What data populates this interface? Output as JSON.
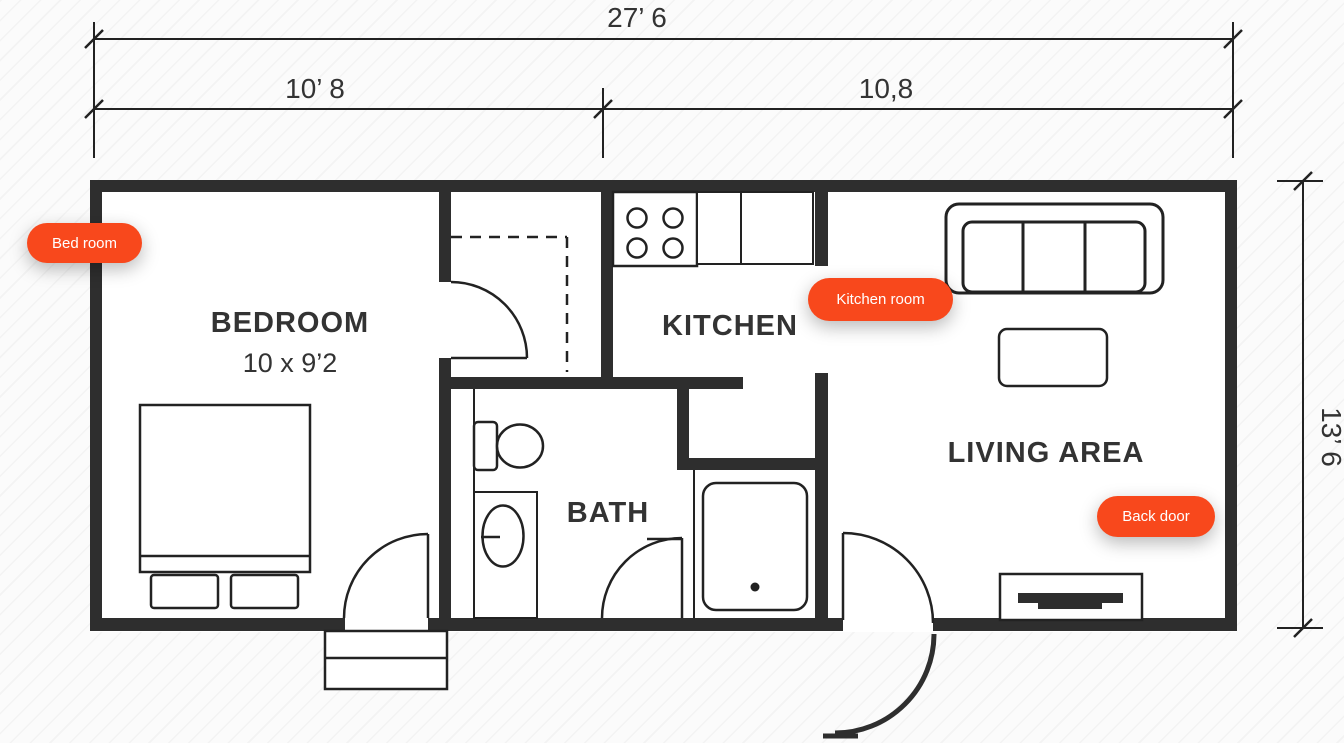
{
  "dimensions": {
    "overall_width": "27’ 6",
    "left_section": "10’ 8",
    "right_section": "10,8",
    "side_height": "13’ 6"
  },
  "rooms": {
    "bedroom": {
      "name": "BEDROOM",
      "size": "10 x 9’2"
    },
    "kitchen": {
      "name": "KITCHEN"
    },
    "bath": {
      "name": "BATH"
    },
    "living": {
      "name": "LIVING AREA"
    }
  },
  "tags": {
    "bedroom": "Bed room",
    "kitchen": "Kitchen room",
    "back_door": "Back door"
  },
  "icons": [
    "bed-icon",
    "pillow-icon",
    "stove-icon",
    "counter-icon",
    "sofa-icon",
    "coffee-table-icon",
    "tv-stand-icon",
    "toilet-icon",
    "sink-vanity-icon",
    "shower-icon",
    "door-swing-icon",
    "steps-icon",
    "dimension-tick-icon",
    "closet-dashed-icon"
  ],
  "colors": {
    "tag_background": "#F8481C",
    "wall": "#2E2E2E",
    "line": "#222222",
    "text": "#333333",
    "floor": "#FFFFFF",
    "background": "#FBFBFB"
  }
}
